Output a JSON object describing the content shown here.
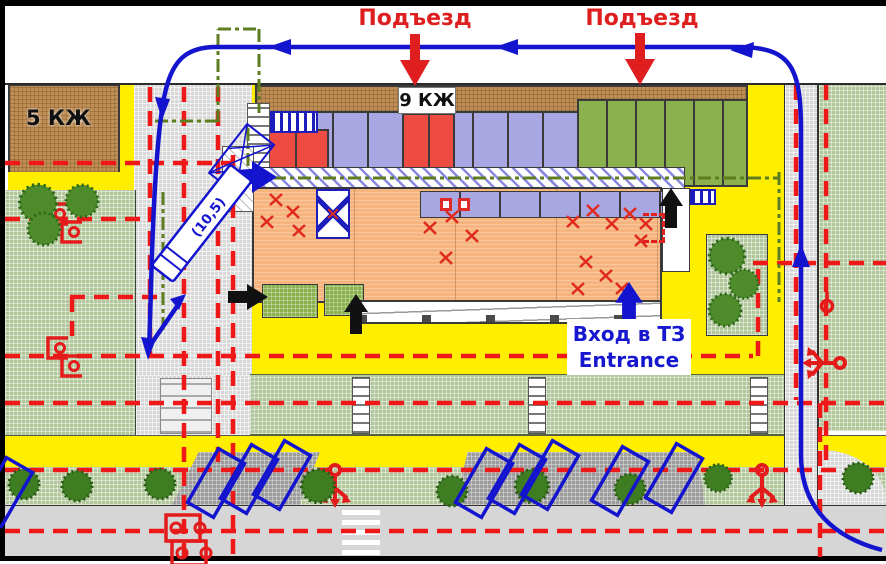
{
  "plan": {
    "labels": {
      "driveway_1": "Подъезд",
      "driveway_2": "Подъезд",
      "building_9kzh": "9 КЖ",
      "building_5kzh": "5 КЖ",
      "truck_length": "(10,5)",
      "entrance_ru": "Вход в ТЗ",
      "entrance_en": "Entrance"
    },
    "colors": {
      "route_blue": "#1414cf",
      "dashed_utility_red": "#ee1818",
      "label_red": "#df1f1f",
      "boundary_dashdot_green": "#5e7d1e",
      "entrance_text_blue": "#1717cf",
      "lawn_green": "#b2c69c",
      "pavement_gray": "#d8d8d8",
      "walkway_yellow": "#ffee00",
      "building_brown": "#c08d52",
      "unit_purple": "#a9a7e2",
      "unit_red": "#ee4b42",
      "unit_green": "#8ab14d",
      "hall_orange": "#f6b47e",
      "parking_pad_gray": "#9c9c9c"
    },
    "symbols": [
      "route-arrow",
      "driveway-arrow",
      "fire-hydrant-trident",
      "manhole-bracket",
      "defect-x-mark",
      "truck-turning-template",
      "parking-space",
      "tree",
      "bush",
      "pedestrian-crosswalk"
    ]
  }
}
